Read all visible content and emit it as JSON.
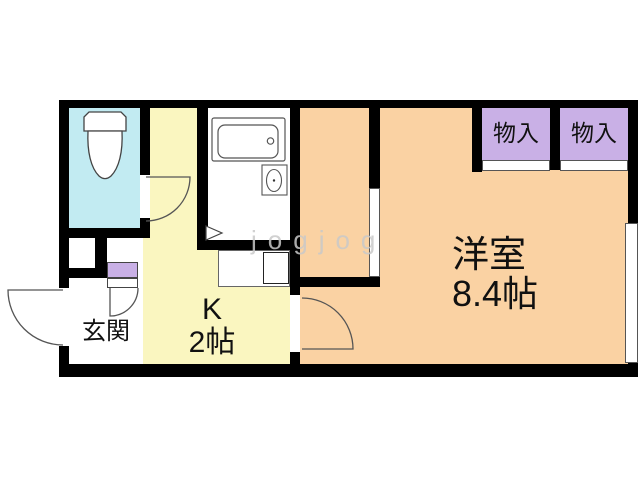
{
  "watermark": "jogjog",
  "rooms": {
    "western_room": {
      "name": "洋室",
      "size": "8.4帖"
    },
    "kitchen": {
      "name": "K",
      "size": "2帖"
    },
    "entrance": {
      "name": "玄関"
    },
    "closets": [
      {
        "label": "物入"
      },
      {
        "label": "物入"
      }
    ]
  },
  "fixtures": {
    "toilet": "toilet-icon",
    "bathtub": "bathtub-icon",
    "washbasin": "washbasin-icon",
    "kitchen_sink": "kitchen-sink-icon",
    "folding_door": "folding-door-icon"
  },
  "colors": {
    "wall": "#000000",
    "toilet_floor": "#c2ebf2",
    "kitchen_floor": "#faf6c0",
    "room_floor": "#fad2a3",
    "closet_fill": "#c9b0e6",
    "watermark_gray": "#c9c9c9"
  }
}
